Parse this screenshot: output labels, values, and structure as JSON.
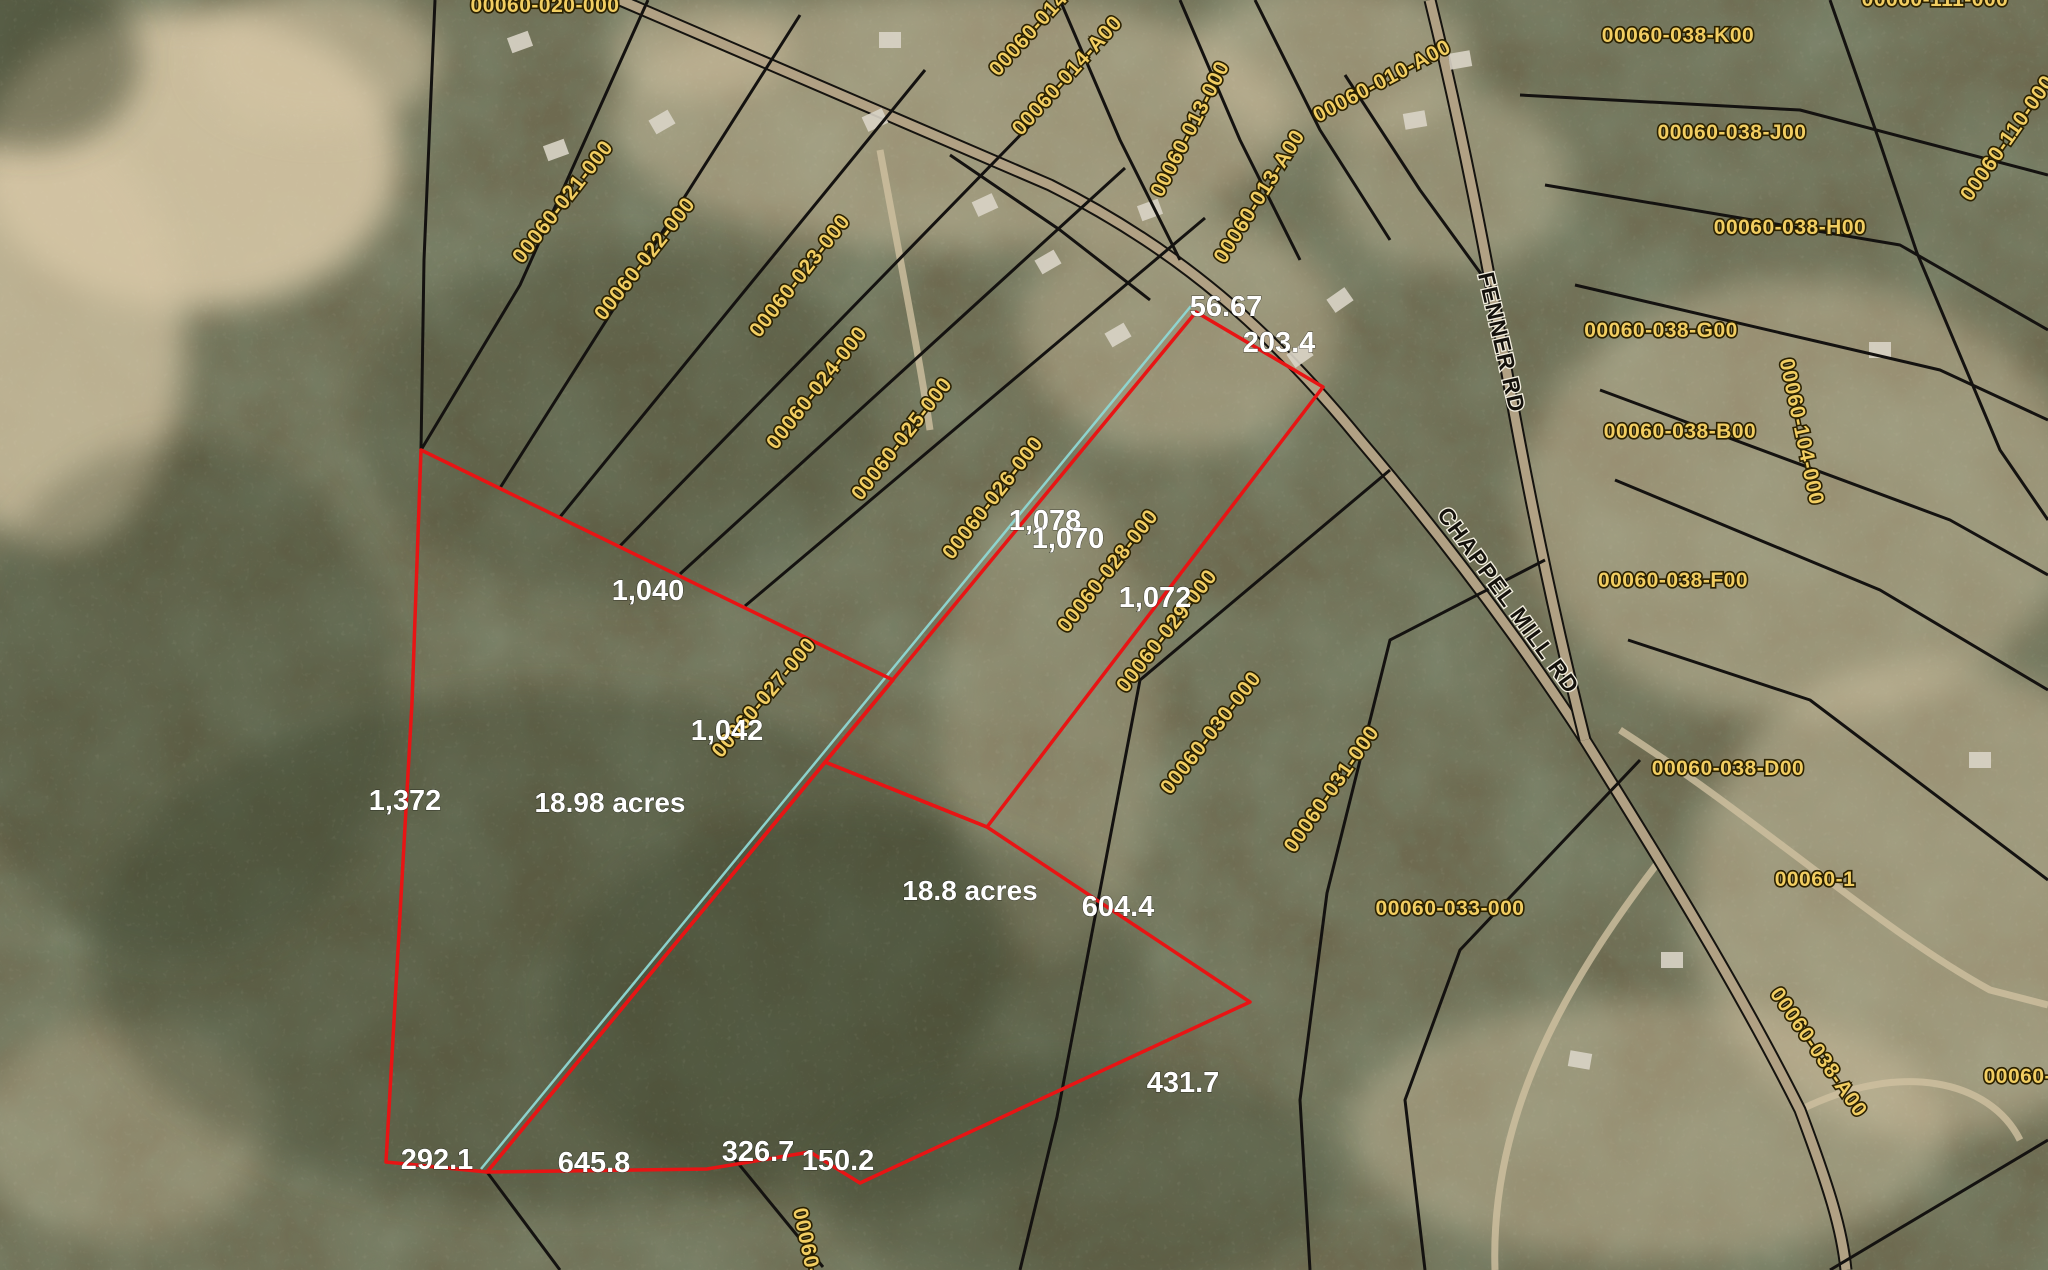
{
  "map": {
    "description": "County GIS aerial parcel map",
    "colors": {
      "highlight_red": "#e81414",
      "survey_teal": "#8fd8d4",
      "parcel_label_yellow": "#f2ce62",
      "boundary_black": "#141210",
      "dimension_white": "#ffffff"
    },
    "parcel_labels": [
      {
        "text": "00060-020-000",
        "x": 545,
        "y": 12,
        "r": 0
      },
      {
        "text": "00060-021-000",
        "x": 568,
        "y": 206,
        "r": -52
      },
      {
        "text": "00060-022-000",
        "x": 650,
        "y": 263,
        "r": -52
      },
      {
        "text": "00060-023-000",
        "x": 805,
        "y": 280,
        "r": -52
      },
      {
        "text": "00060-024-000",
        "x": 822,
        "y": 392,
        "r": -52
      },
      {
        "text": "00060-025-000",
        "x": 907,
        "y": 443,
        "r": -52
      },
      {
        "text": "00060-026-000",
        "x": 998,
        "y": 502,
        "r": -52
      },
      {
        "text": "00060-027-000",
        "x": 769,
        "y": 702,
        "r": -50
      },
      {
        "text": "00060-028-000",
        "x": 1113,
        "y": 575,
        "r": -52
      },
      {
        "text": "00060-029-000",
        "x": 1172,
        "y": 635,
        "r": -52
      },
      {
        "text": "00060-030-000",
        "x": 1216,
        "y": 737,
        "r": -52
      },
      {
        "text": "00060-031-000",
        "x": 1337,
        "y": 793,
        "r": -55
      },
      {
        "text": "00060-033-000",
        "x": 1450,
        "y": 915,
        "r": 0
      },
      {
        "text": "00060-013-000",
        "x": 1196,
        "y": 132,
        "r": -63
      },
      {
        "text": "00060-013-A00",
        "x": 1265,
        "y": 200,
        "r": -58
      },
      {
        "text": "00060-014-000",
        "x": 1048,
        "y": 22,
        "r": -48
      },
      {
        "text": "00060-014-A00",
        "x": 1072,
        "y": 80,
        "r": -48
      },
      {
        "text": "00060-010-A00",
        "x": 1385,
        "y": 87,
        "r": -28
      },
      {
        "text": "00060-038-K00",
        "x": 1678,
        "y": 42,
        "r": 0
      },
      {
        "text": "00060-038-J00",
        "x": 1732,
        "y": 139,
        "r": 0
      },
      {
        "text": "00060-038-H00",
        "x": 1790,
        "y": 234,
        "r": 0
      },
      {
        "text": "00060-038-G00",
        "x": 1661,
        "y": 337,
        "r": 0
      },
      {
        "text": "00060-038-B00",
        "x": 1680,
        "y": 438,
        "r": 0
      },
      {
        "text": "00060-038-F00",
        "x": 1673,
        "y": 587,
        "r": 0
      },
      {
        "text": "00060-038-D00",
        "x": 1728,
        "y": 775,
        "r": 0
      },
      {
        "text": "00060-038-A00",
        "x": 1813,
        "y": 1056,
        "r": 55
      },
      {
        "text": "00060-104-000",
        "x": 1795,
        "y": 433,
        "r": 78
      },
      {
        "text": "00060-110-000",
        "x": 2013,
        "y": 142,
        "r": -55
      },
      {
        "text": "00060-111-000",
        "x": 1935,
        "y": 6,
        "r": 0
      },
      {
        "text": "00060-1",
        "x": 1815,
        "y": 886,
        "r": 0
      },
      {
        "text": "00060-10",
        "x": 2030,
        "y": 1083,
        "r": 0
      },
      {
        "text": "00060-",
        "x": 800,
        "y": 1243,
        "r": 78
      }
    ],
    "dimension_labels": [
      {
        "text": "56.67",
        "x": 1226,
        "y": 316
      },
      {
        "text": "203.4",
        "x": 1279,
        "y": 352
      },
      {
        "text": "1,078",
        "x": 1045,
        "y": 530
      },
      {
        "text": "1,070",
        "x": 1068,
        "y": 548
      },
      {
        "text": "1,072",
        "x": 1155,
        "y": 607
      },
      {
        "text": "1,040",
        "x": 648,
        "y": 600
      },
      {
        "text": "1,372",
        "x": 405,
        "y": 810
      },
      {
        "text": "1,042",
        "x": 727,
        "y": 740
      },
      {
        "text": "604.4",
        "x": 1118,
        "y": 916
      },
      {
        "text": "431.7",
        "x": 1183,
        "y": 1092
      },
      {
        "text": "292.1",
        "x": 437,
        "y": 1169
      },
      {
        "text": "645.8",
        "x": 594,
        "y": 1172
      },
      {
        "text": "326.7",
        "x": 758,
        "y": 1161
      },
      {
        "text": "150.2",
        "x": 838,
        "y": 1170
      }
    ],
    "area_labels": [
      {
        "text": "18.98 acres",
        "x": 610,
        "y": 812
      },
      {
        "text": "18.8 acres",
        "x": 970,
        "y": 900
      }
    ],
    "road_labels": [
      {
        "text": "FENNER RD",
        "x": 1494,
        "y": 344,
        "r": 77
      },
      {
        "text": "CHAPPEL MILL RD",
        "x": 1502,
        "y": 605,
        "r": 54
      }
    ],
    "highlight": {
      "stroke_width": 3.5,
      "polygons": [
        {
          "name": "highlight-strip-parcel",
          "points": "1196,312 1323,387 987,827 825,762"
        },
        {
          "name": "highlight-west-tract",
          "points": "421,450 893,680 487,1172 386,1162 412,703"
        },
        {
          "name": "highlight-east-tract",
          "points": "825,762 987,827 1250,1002 860,1183 810,1152 707,1169 487,1172"
        }
      ],
      "survey_line": {
        "x1": 1191,
        "y1": 306,
        "x2": 481,
        "y2": 1169
      }
    }
  }
}
